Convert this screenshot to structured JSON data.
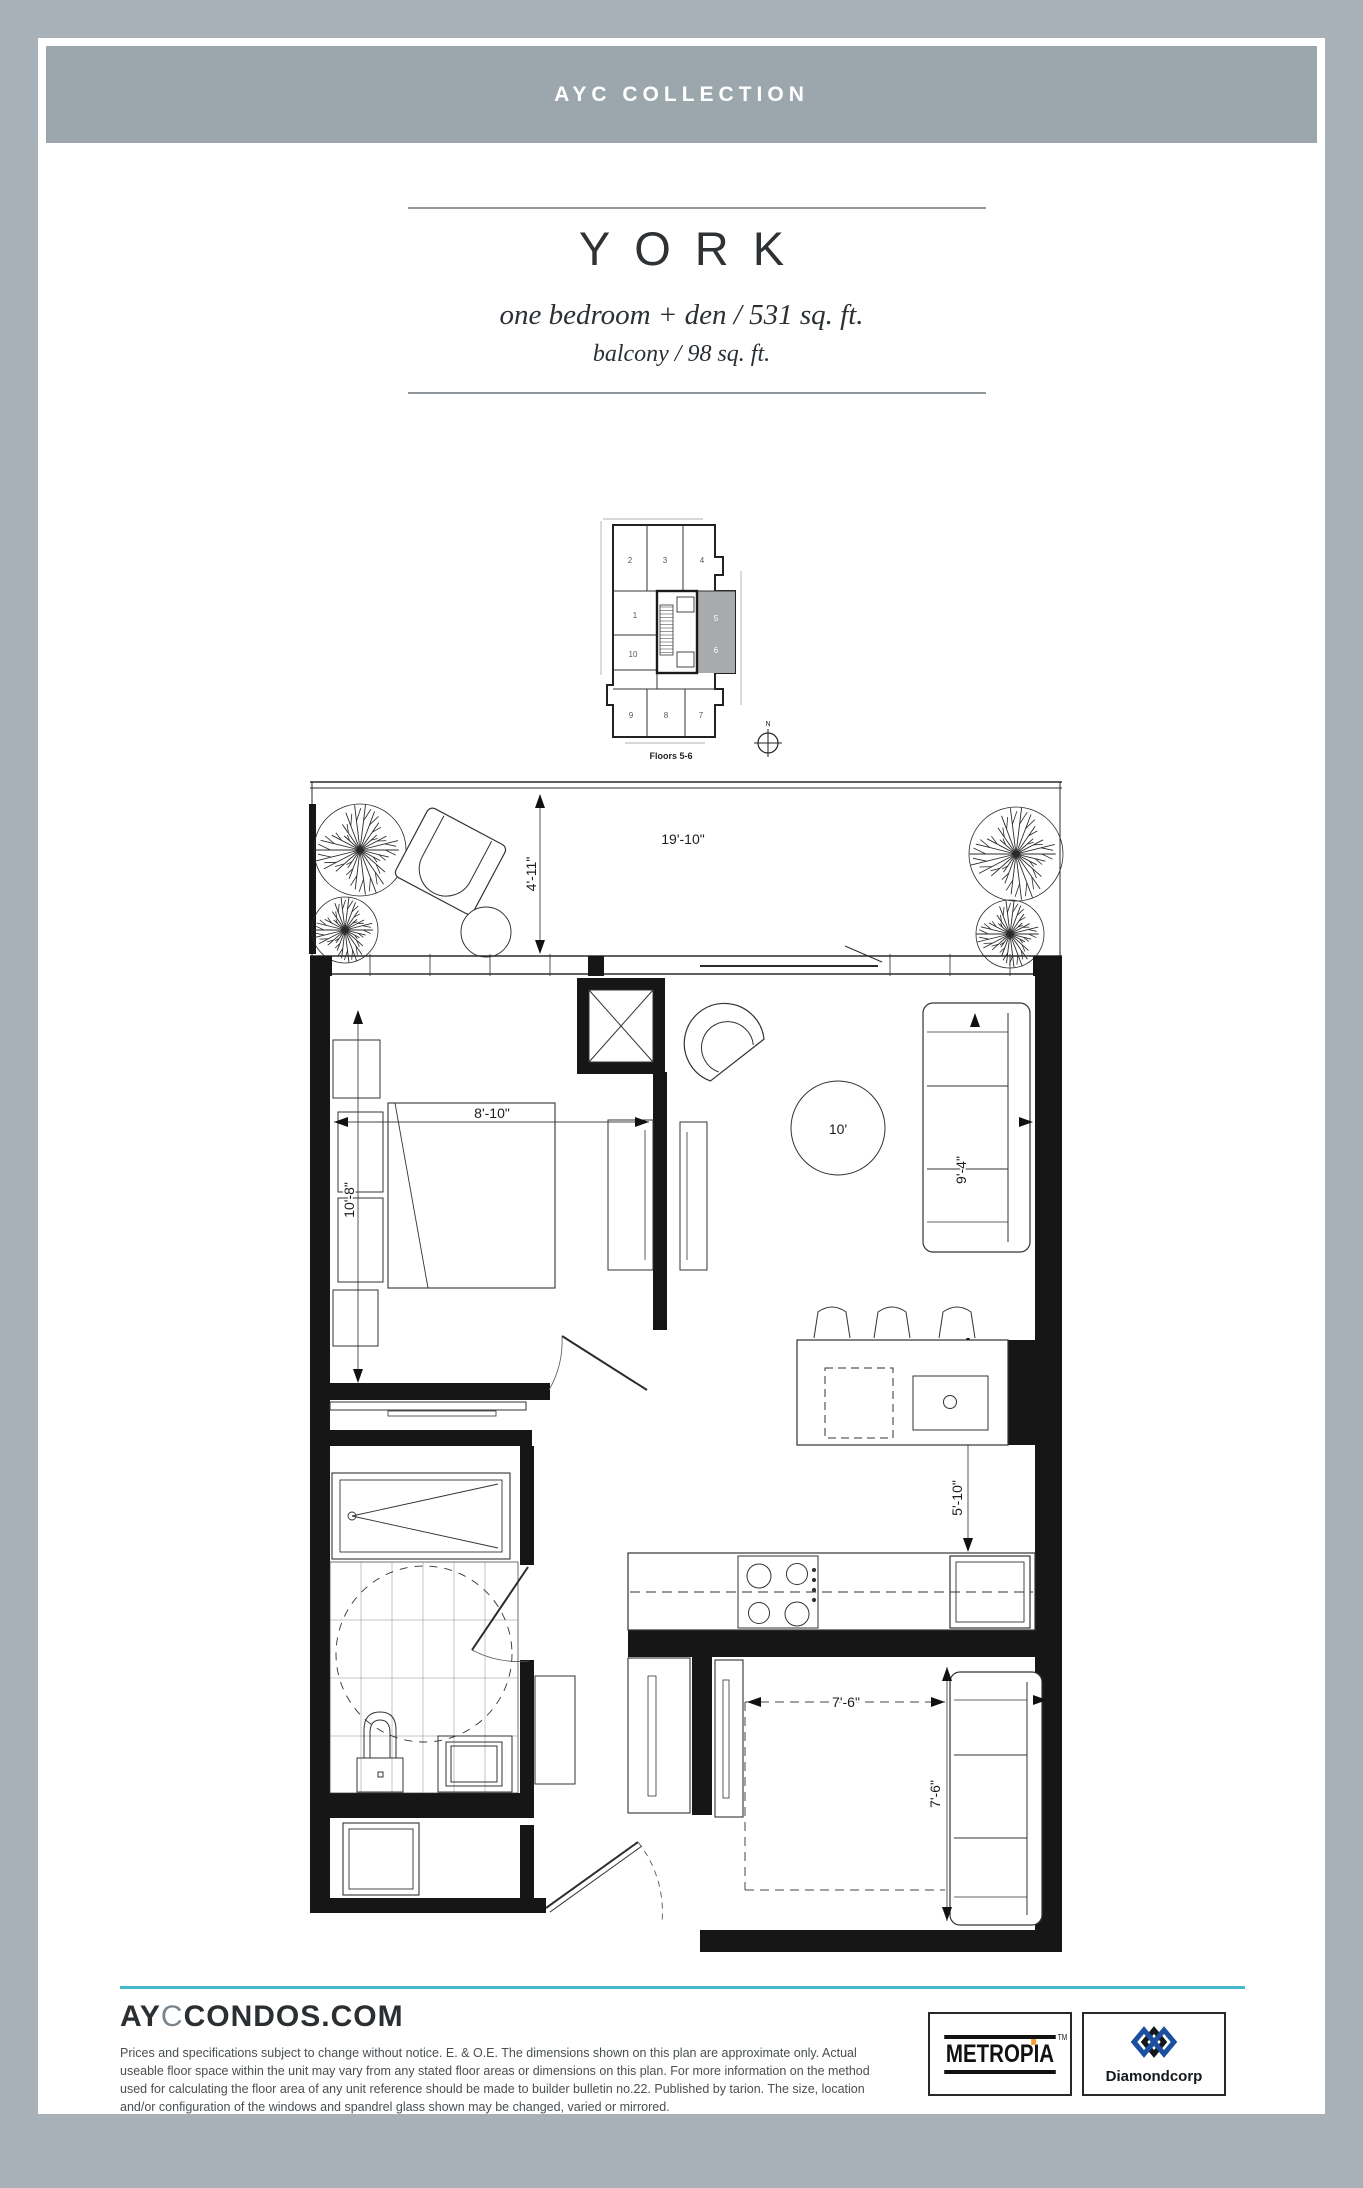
{
  "page": {
    "collection": "AYC COLLECTION"
  },
  "title": {
    "name": "YORK",
    "spec": "one bedroom + den / 531 sq. ft.",
    "balcony": "balcony / 98 sq. ft."
  },
  "key_plan": {
    "caption": "Floors 5-6",
    "compass": "N",
    "units": {
      "u1": "1",
      "u2": "2",
      "u3": "3",
      "u4": "4",
      "u5": "5",
      "u6": "6",
      "u7": "7",
      "u8": "8",
      "u9": "9",
      "u10": "10"
    },
    "highlighted_units": "5, 6"
  },
  "floor_plan": {
    "dimensions": {
      "balcony_width": "19'-10\"",
      "balcony_depth": "4'-11\"",
      "bedroom_width": "8'-10\"",
      "bedroom_depth": "10'-8\"",
      "living_rug": "10'",
      "living_depth": "9'-4\"",
      "island": "5'-10\"",
      "den_width": "7'-6\"",
      "den_depth": "7'-6\""
    }
  },
  "footer": {
    "brand_prefix": "AY",
    "brand_mid": "C",
    "brand_suffix": "CONDOS.COM",
    "legal": "Prices and specifications subject to change without notice. E. & O.E. The dimensions shown on this plan are approximate only. Actual useable floor space within the unit may vary from any stated floor areas or dimensions on this plan. For more information on the method used for calculating the floor area of any unit reference should be made to builder bulletin no.22. Published by tarion. The size, location and/or configuration of the windows and spandrel glass shown may be changed, varied or mirrored.",
    "logos": {
      "metropia": "METROPIA",
      "metropia_tm": "TM",
      "diamondcorp": "Diamondcorp"
    }
  },
  "colors": {
    "frame": "#a9b1b8",
    "header_bar": "#9ca6ad",
    "accent_teal": "#44b8cc",
    "keyplan_highlight": "#a8aaab"
  }
}
